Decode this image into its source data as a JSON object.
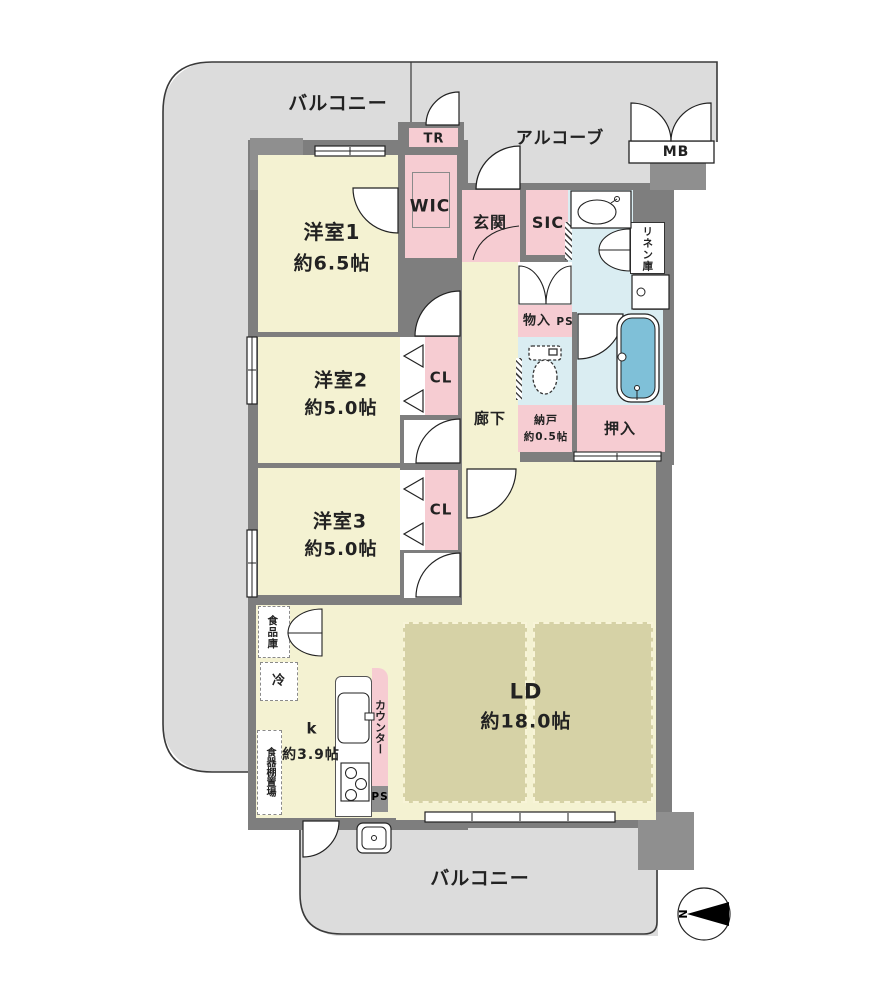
{
  "plan": {
    "balcony_top": {
      "label": "バルコニー"
    },
    "alcove": {
      "label": "アルコーブ"
    },
    "meter_box": {
      "label": "MB"
    },
    "trunk_room": {
      "label": "TR"
    },
    "walk_in_closet": {
      "label": "WIC"
    },
    "entrance": {
      "label": "玄関"
    },
    "shoes_in_closet": {
      "label": "SIC"
    },
    "linen_closet": {
      "label": "リネン庫"
    },
    "bedroom1": {
      "label": "洋室1",
      "size": "約6.5帖"
    },
    "storage_monoire": {
      "label": "物入",
      "ps": "PS"
    },
    "bedroom2": {
      "label": "洋室2",
      "size": "約5.0帖"
    },
    "closet2": {
      "label": "CL"
    },
    "hallway": {
      "label": "廊下"
    },
    "storage_nando": {
      "label": "納戸",
      "size": "約0.5帖"
    },
    "futon_closet": {
      "label": "押入"
    },
    "bedroom3": {
      "label": "洋室3",
      "size": "約5.0帖"
    },
    "closet3": {
      "label": "CL"
    },
    "pantry": {
      "label": "食品庫"
    },
    "fridge": {
      "label": "冷"
    },
    "kitchen": {
      "label": "k",
      "size": "約3.9帖"
    },
    "counter": {
      "label": "カウンター"
    },
    "pipe_space_kitchen": {
      "label": "PS"
    },
    "dish_shelf": {
      "label": "食器棚置場"
    },
    "living_dining": {
      "label": "LD",
      "size": "約18.0帖"
    },
    "balcony_bottom": {
      "label": "バルコニー"
    },
    "compass": {
      "north_label": "N"
    }
  },
  "colors": {
    "room_floor": "#f4f2d2",
    "closet_pink": "#f6ccd2",
    "wet_area_blue": "#daedf2",
    "bathtub_blue": "#7fc0d8",
    "balcony_gray": "#dcdcdc",
    "wall_gray": "#7e7e7e",
    "carpet_khaki": "#d6d2a6"
  }
}
